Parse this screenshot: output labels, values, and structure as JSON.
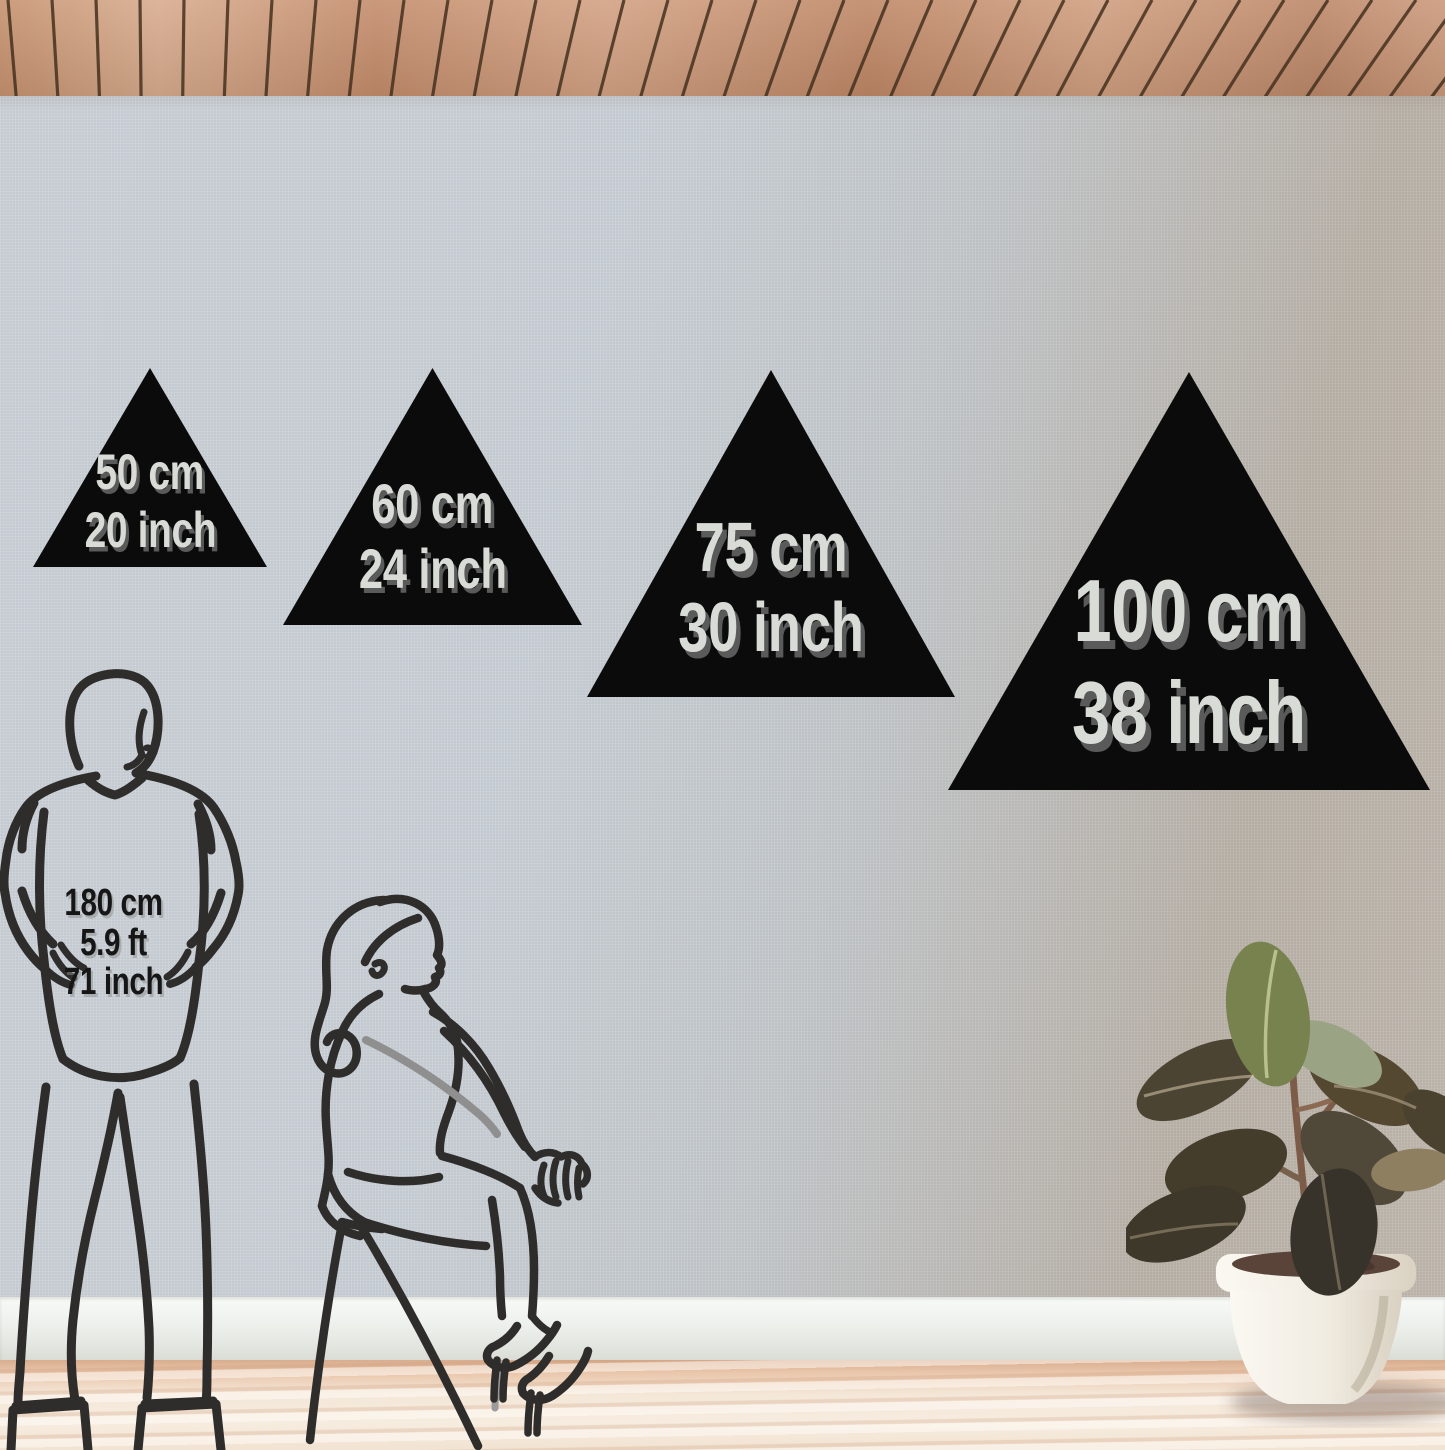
{
  "scene": {
    "title": "Triangle wall decor size comparison in room"
  },
  "triangles": [
    {
      "cm": "50 cm",
      "inch": "20 inch"
    },
    {
      "cm": "60 cm",
      "inch": "24 inch"
    },
    {
      "cm": "75 cm",
      "inch": "30 inch"
    },
    {
      "cm": "100 cm",
      "inch": "38 inch"
    }
  ],
  "height_reference": {
    "cm": "180 cm",
    "ft": "5.9 ft",
    "inch": "71 inch"
  },
  "colors": {
    "triangle": "#0b0b0b",
    "triangle_label": "#d9dbd7",
    "triangle_label_shadow": "#5a5a5a",
    "reference_text": "#161616",
    "figure_line": "#2e2d2b",
    "ceiling_wood": "#cb9778",
    "ceiling_gap": "#45311f",
    "wall_light": "#ccd3da",
    "wall_dark": "#bab3aa",
    "baseboard": "#eef1ed",
    "floor": "#f4e7d8",
    "pot": "#f1ece2",
    "leaf_green": "#77824e",
    "leaf_dark": "#443d2b"
  }
}
